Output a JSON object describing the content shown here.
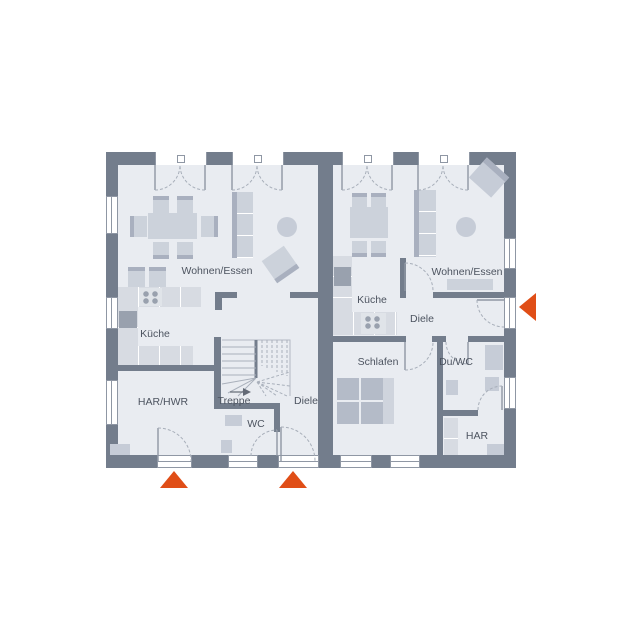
{
  "plan_type": "floor-plan-duplex-ground-floor",
  "colors": {
    "wall": "#737d8c",
    "floor": "#e9ecf1",
    "furniture": "#ccd2db",
    "furniture_dark": "#a9b0bf",
    "furniture_mid": "#c6ccd7",
    "appliance": "#99a1ae",
    "accent": "#e04e17",
    "label": "#4d5460",
    "line": "#8f97a4",
    "arc": "#a7aeb9"
  },
  "rooms": [
    {
      "unit": "left",
      "id": "wohnen-essen",
      "label": "Wohnen/Essen"
    },
    {
      "unit": "left",
      "id": "kueche",
      "label": "Küche"
    },
    {
      "unit": "left",
      "id": "har-hwr",
      "label": "HAR/HWR"
    },
    {
      "unit": "left",
      "id": "treppe",
      "label": "Treppe"
    },
    {
      "unit": "left",
      "id": "diele",
      "label": "Diele"
    },
    {
      "unit": "left",
      "id": "wc",
      "label": "WC"
    },
    {
      "unit": "right",
      "id": "kueche",
      "label": "Küche"
    },
    {
      "unit": "right",
      "id": "wohnen-essen",
      "label": "Wohnen/Essen"
    },
    {
      "unit": "right",
      "id": "diele",
      "label": "Diele"
    },
    {
      "unit": "right",
      "id": "schlafen",
      "label": "Schlafen"
    },
    {
      "unit": "right",
      "id": "du-wc",
      "label": "Du/WC"
    },
    {
      "unit": "right",
      "id": "har",
      "label": "HAR"
    }
  ],
  "markers": [
    {
      "type": "entrance-arrow",
      "wall": "bottom",
      "unit": "left"
    },
    {
      "type": "entrance-arrow",
      "wall": "bottom",
      "unit": "left"
    },
    {
      "type": "entrance-arrow",
      "wall": "right",
      "unit": "right"
    }
  ]
}
